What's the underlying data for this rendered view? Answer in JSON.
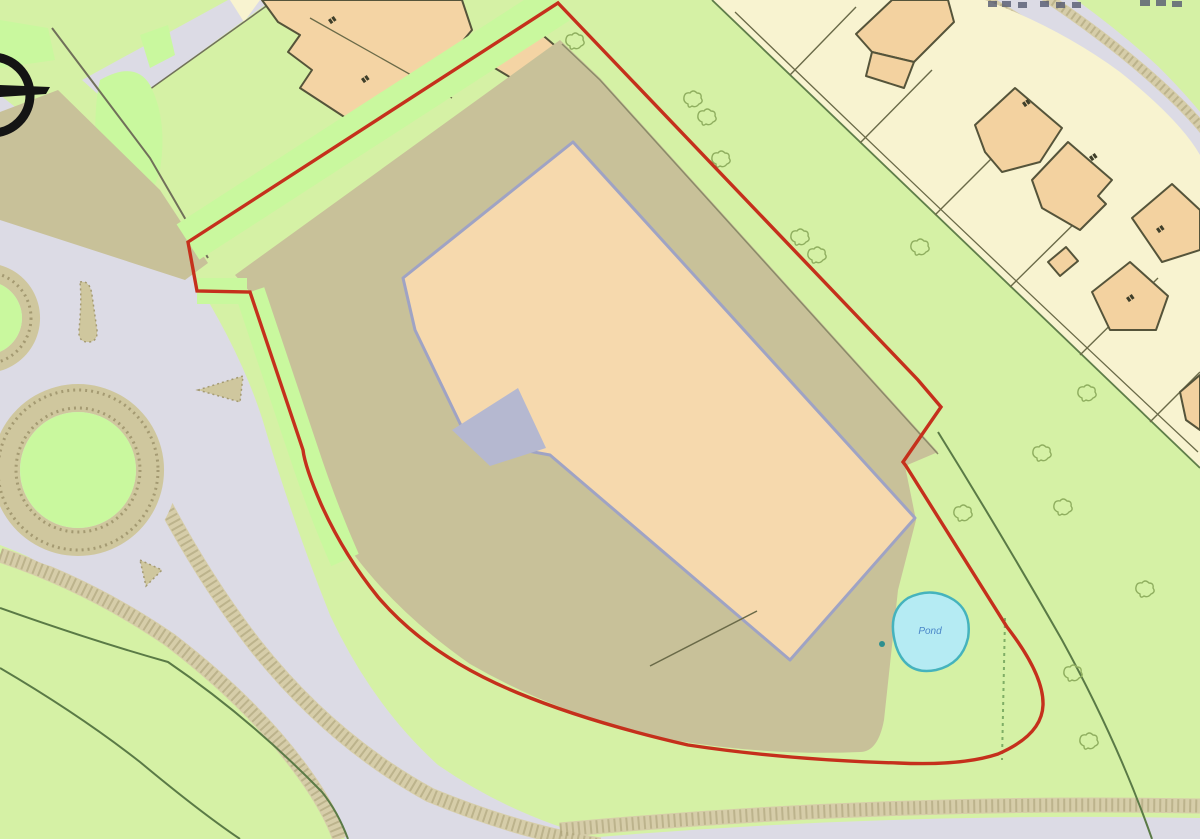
{
  "map": {
    "type": "site-location-plan",
    "pond": {
      "label": "Pond",
      "label_color": "#4a86c8"
    },
    "boundary": {
      "color": "#c5301c",
      "description": "red site boundary outline"
    },
    "colors": {
      "field_green": "#d5f1a5",
      "verge_green": "#c9f89e",
      "road_grey": "#dcdbe5",
      "hardstanding_khaki": "#c8c199",
      "path_tan": "#d6cda9",
      "path_dot": "#a89e74",
      "parcel_cream": "#f8f3d0",
      "building_peach": "#f6d9ad",
      "house_peach": "#f3d2a0",
      "building_edge": "#9fa3c4",
      "house_edge": "#55543a",
      "field_line": "#5a7a46",
      "pond_fill": "#b5ebf3",
      "pond_edge": "#45b3bd",
      "symbol_black": "#141414"
    }
  }
}
